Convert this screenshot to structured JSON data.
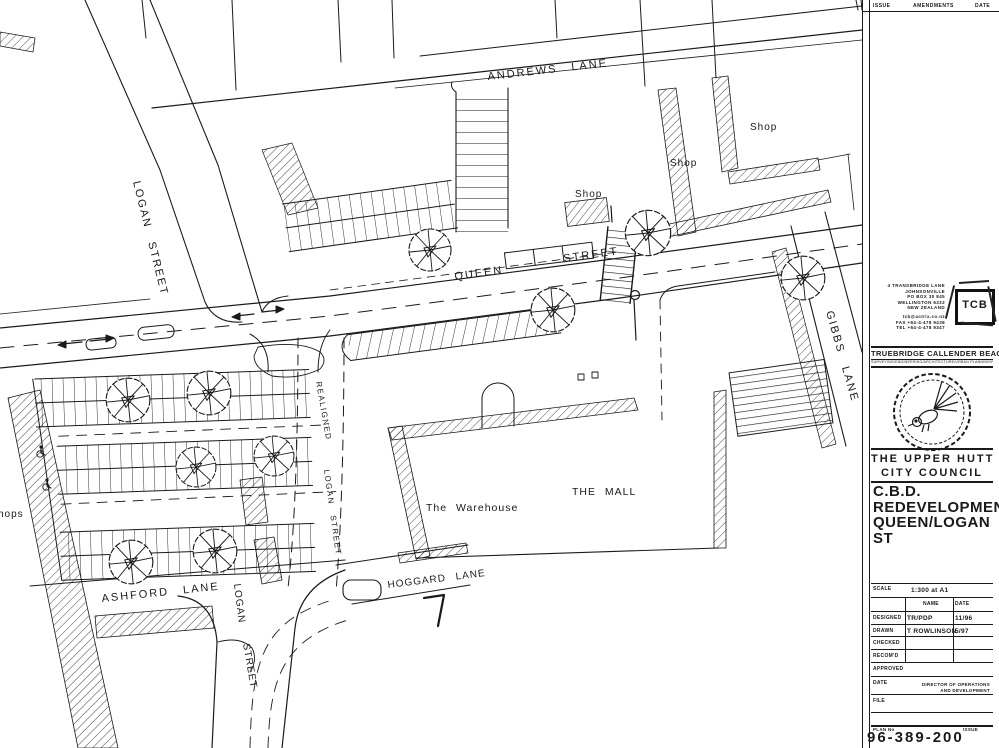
{
  "colors": {
    "ink": "#1a1a1a",
    "paper": "#ffffff"
  },
  "header": {
    "issue": "ISSUE",
    "amendments": "AMENDMENTS",
    "date": "DATE"
  },
  "plan_labels": {
    "andrews_lane": "ANDREWS LANE",
    "queen": "QUEEN",
    "street": "STREET",
    "logan_street_upper": "LOGAN STREET",
    "gibbs_lane": "GIBBS LANE",
    "shops": [
      "Shop",
      "Shop",
      "Shop"
    ],
    "shops_left_partial": "hops",
    "the_mall": "THE MALL",
    "warehouse": "The Warehouse",
    "realigned": "REALIGNED",
    "logan_street_mid": "LOGAN STREET",
    "ashford_lane": "ASHFORD LANE",
    "hoggard_lane": "HOGGARD LANE",
    "logan_lower": "LOGAN",
    "street_lower": "STREET"
  },
  "titleblock": {
    "address_lines": [
      "4 TRANSBRIDGE LANE",
      "JOHNSONVILLE",
      "PO BOX 30 845",
      "WELLINGTON 6332",
      "NEW ZEALAND",
      "tcb@actrix.co.nz",
      "FAX +64-4-478 9438",
      "TEL +64-4-478 9347"
    ],
    "logo_text": "TCB",
    "company": "TRUEBRIDGE CALLENDER BEACH LTD",
    "tagline": "SURVEYING/ENGINEERING/ARCHITECTURE/URBAN PLANNING/RESOURCE MANAGEMENT",
    "council_line1": "THE UPPER HUTT",
    "council_line2": "CITY COUNCIL",
    "title_line1": "C.B.D.",
    "title_line2": "REDEVELOPMENT",
    "title_line3": "QUEEN/LOGAN ST",
    "scale_label": "SCALE",
    "scale_value": "1:300 at A1",
    "col_name": "NAME",
    "col_date": "DATE",
    "rows": [
      {
        "label": "DESIGNED",
        "name": "TR/PDP",
        "date": "11/96"
      },
      {
        "label": "DRAWN",
        "name": "T ROWLINSON",
        "date": "5/97"
      },
      {
        "label": "CHECKED",
        "name": "",
        "date": ""
      },
      {
        "label": "RECOM'D",
        "name": "",
        "date": ""
      }
    ],
    "approved_label": "APPROVED",
    "date_label": "DATE",
    "director_line1": "DIRECTOR OF OPERATIONS",
    "director_line2": "AND DEVELOPMENT",
    "file_label": "FILE",
    "plan_no_label": "PLAN No",
    "issue_label": "ISSUE",
    "plan_number": "96-389-200"
  }
}
